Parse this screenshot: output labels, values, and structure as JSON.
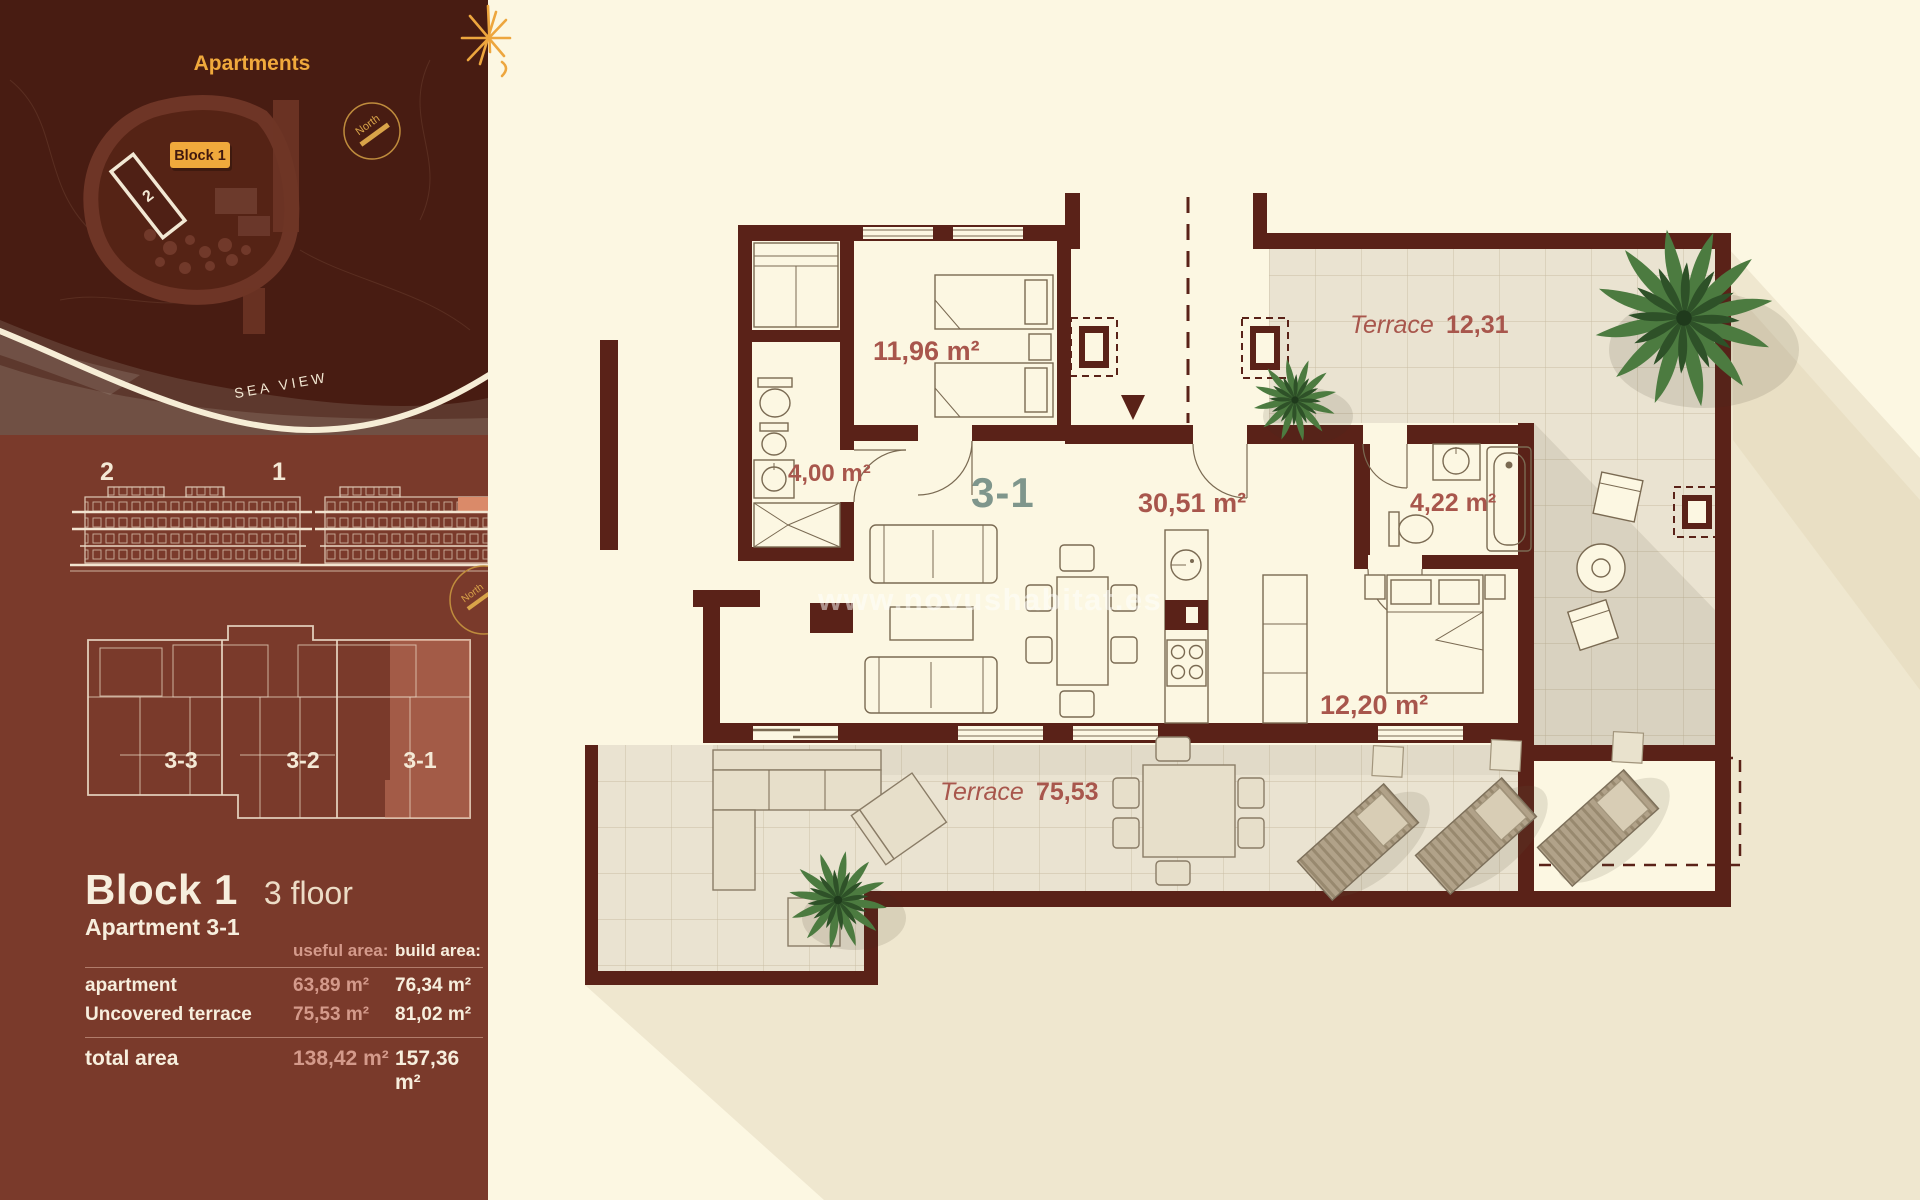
{
  "colors": {
    "wall": "#5a2218",
    "cream": "#fcf7e2",
    "tile": "#eae3d1",
    "tileLine": "#c9bda3",
    "label": "#a8564c",
    "sage": "#7f968c",
    "gold": "#eda63e",
    "sidebarDark": "#481c12",
    "sidebarRust": "#7a3a2b",
    "creamText": "#f7eedd",
    "rosyText": "#d49a8b",
    "salmon": "#d4846a",
    "shadow": "#efe7cf",
    "furn": "#7a6a52",
    "green1": "#4c7b40",
    "green2": "#2e5128"
  },
  "sidebar": {
    "map": {
      "title": "Apartments",
      "block_badge": "Block 1",
      "building_2_label": "2",
      "north_label": "North",
      "sea_view_label": "SEA VIEW"
    },
    "elevations": {
      "building_2_label": "2",
      "building_1_label": "1"
    },
    "overview": {
      "north_label": "North",
      "units": [
        {
          "label": "3-3"
        },
        {
          "label": "3-2"
        },
        {
          "label": "3-1"
        }
      ]
    },
    "details": {
      "block_title": "Block 1",
      "floor": "3 floor",
      "apartment": "Apartment 3-1",
      "table": {
        "headers": {
          "useful": "useful area:",
          "build": "build area:"
        },
        "rows": [
          {
            "label": "apartment",
            "useful": "63,89 m²",
            "build": "76,34 m²"
          },
          {
            "label": "Uncovered terrace",
            "useful": "75,53 m²",
            "build": "81,02 m²"
          }
        ],
        "total": {
          "label": "total area",
          "useful": "138,42 m²",
          "build": "157,36 m²"
        }
      }
    }
  },
  "plan": {
    "unit_label": "3-1",
    "watermark": "www.novushabitat.es",
    "rooms": {
      "bedroom1": "11,96 m²",
      "bathroom1": "4,00 m²",
      "living": "30,51 m²",
      "bathroom2": "4,22 m²",
      "bedroom2": "12,20 m²"
    },
    "terraces": {
      "upper": {
        "name": "Terrace",
        "area": "12,31"
      },
      "lower": {
        "name": "Terrace",
        "area": "75,53"
      }
    }
  }
}
